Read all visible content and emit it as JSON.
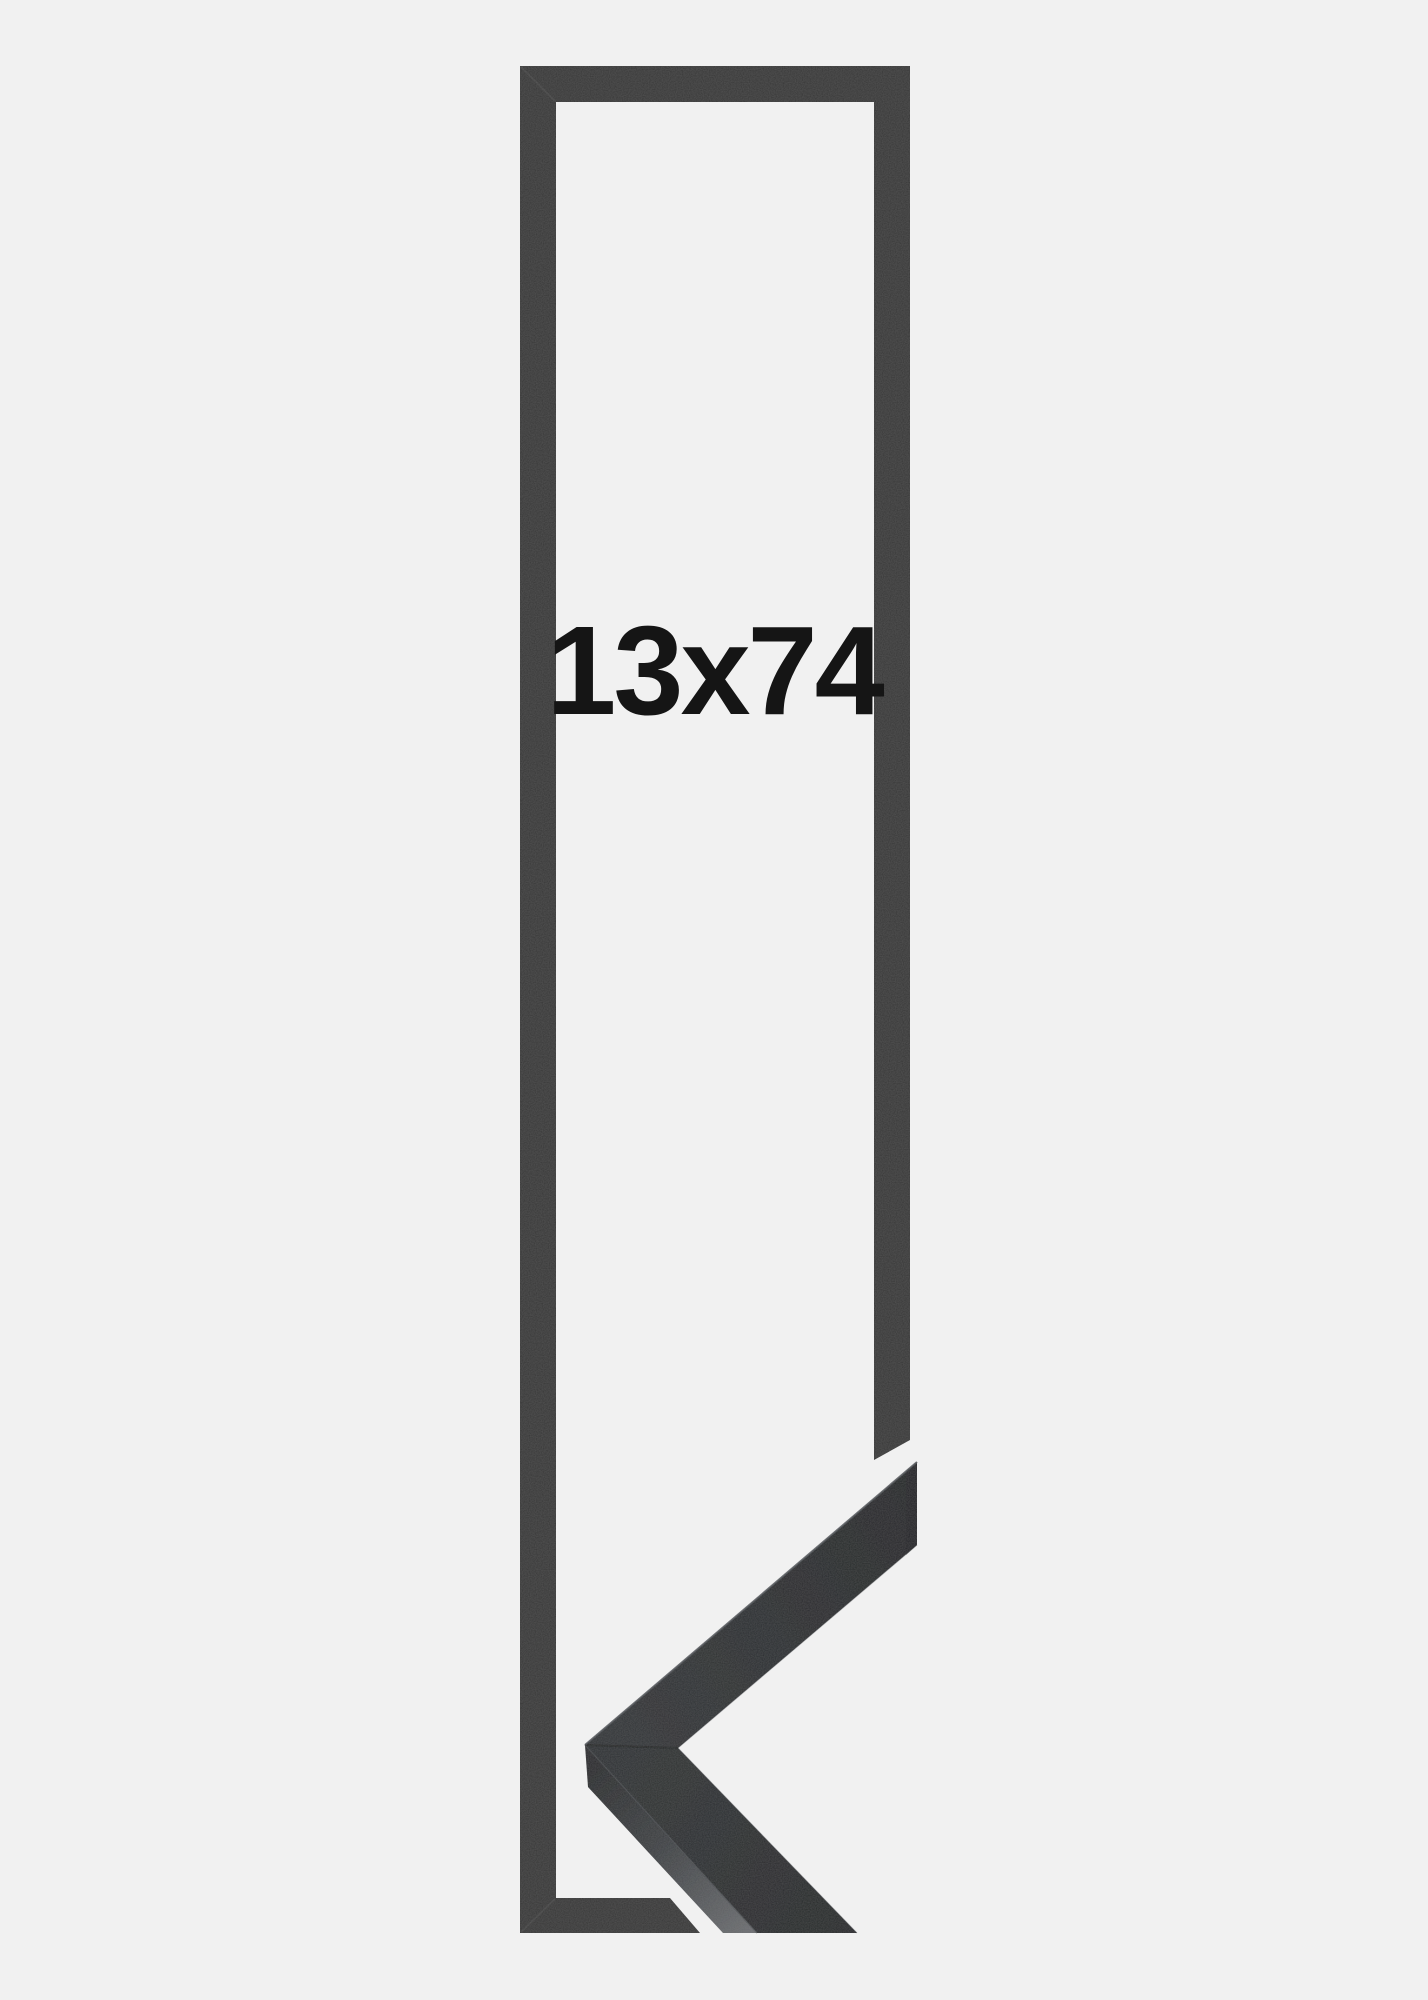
{
  "size_label": {
    "text": "13x74"
  },
  "colors": {
    "background": "#f1f1f1",
    "frame_outline": "#393939",
    "label_text": "#151515",
    "miter_line": "#474747",
    "moulding_face_light": "#313437",
    "moulding_face_dark": "#242628",
    "moulding_lower_light": "#2f3234",
    "moulding_lower_dark": "#26282a",
    "moulding_side_start": "#292b2d",
    "moulding_side_mid": "#3e4144",
    "moulding_side_end": "#6a6c6f",
    "edge_highlight": "#4d5155",
    "arris_highlight": "#45484c",
    "seam_line": "#1c1e20",
    "end_cut": "#1f2123"
  }
}
